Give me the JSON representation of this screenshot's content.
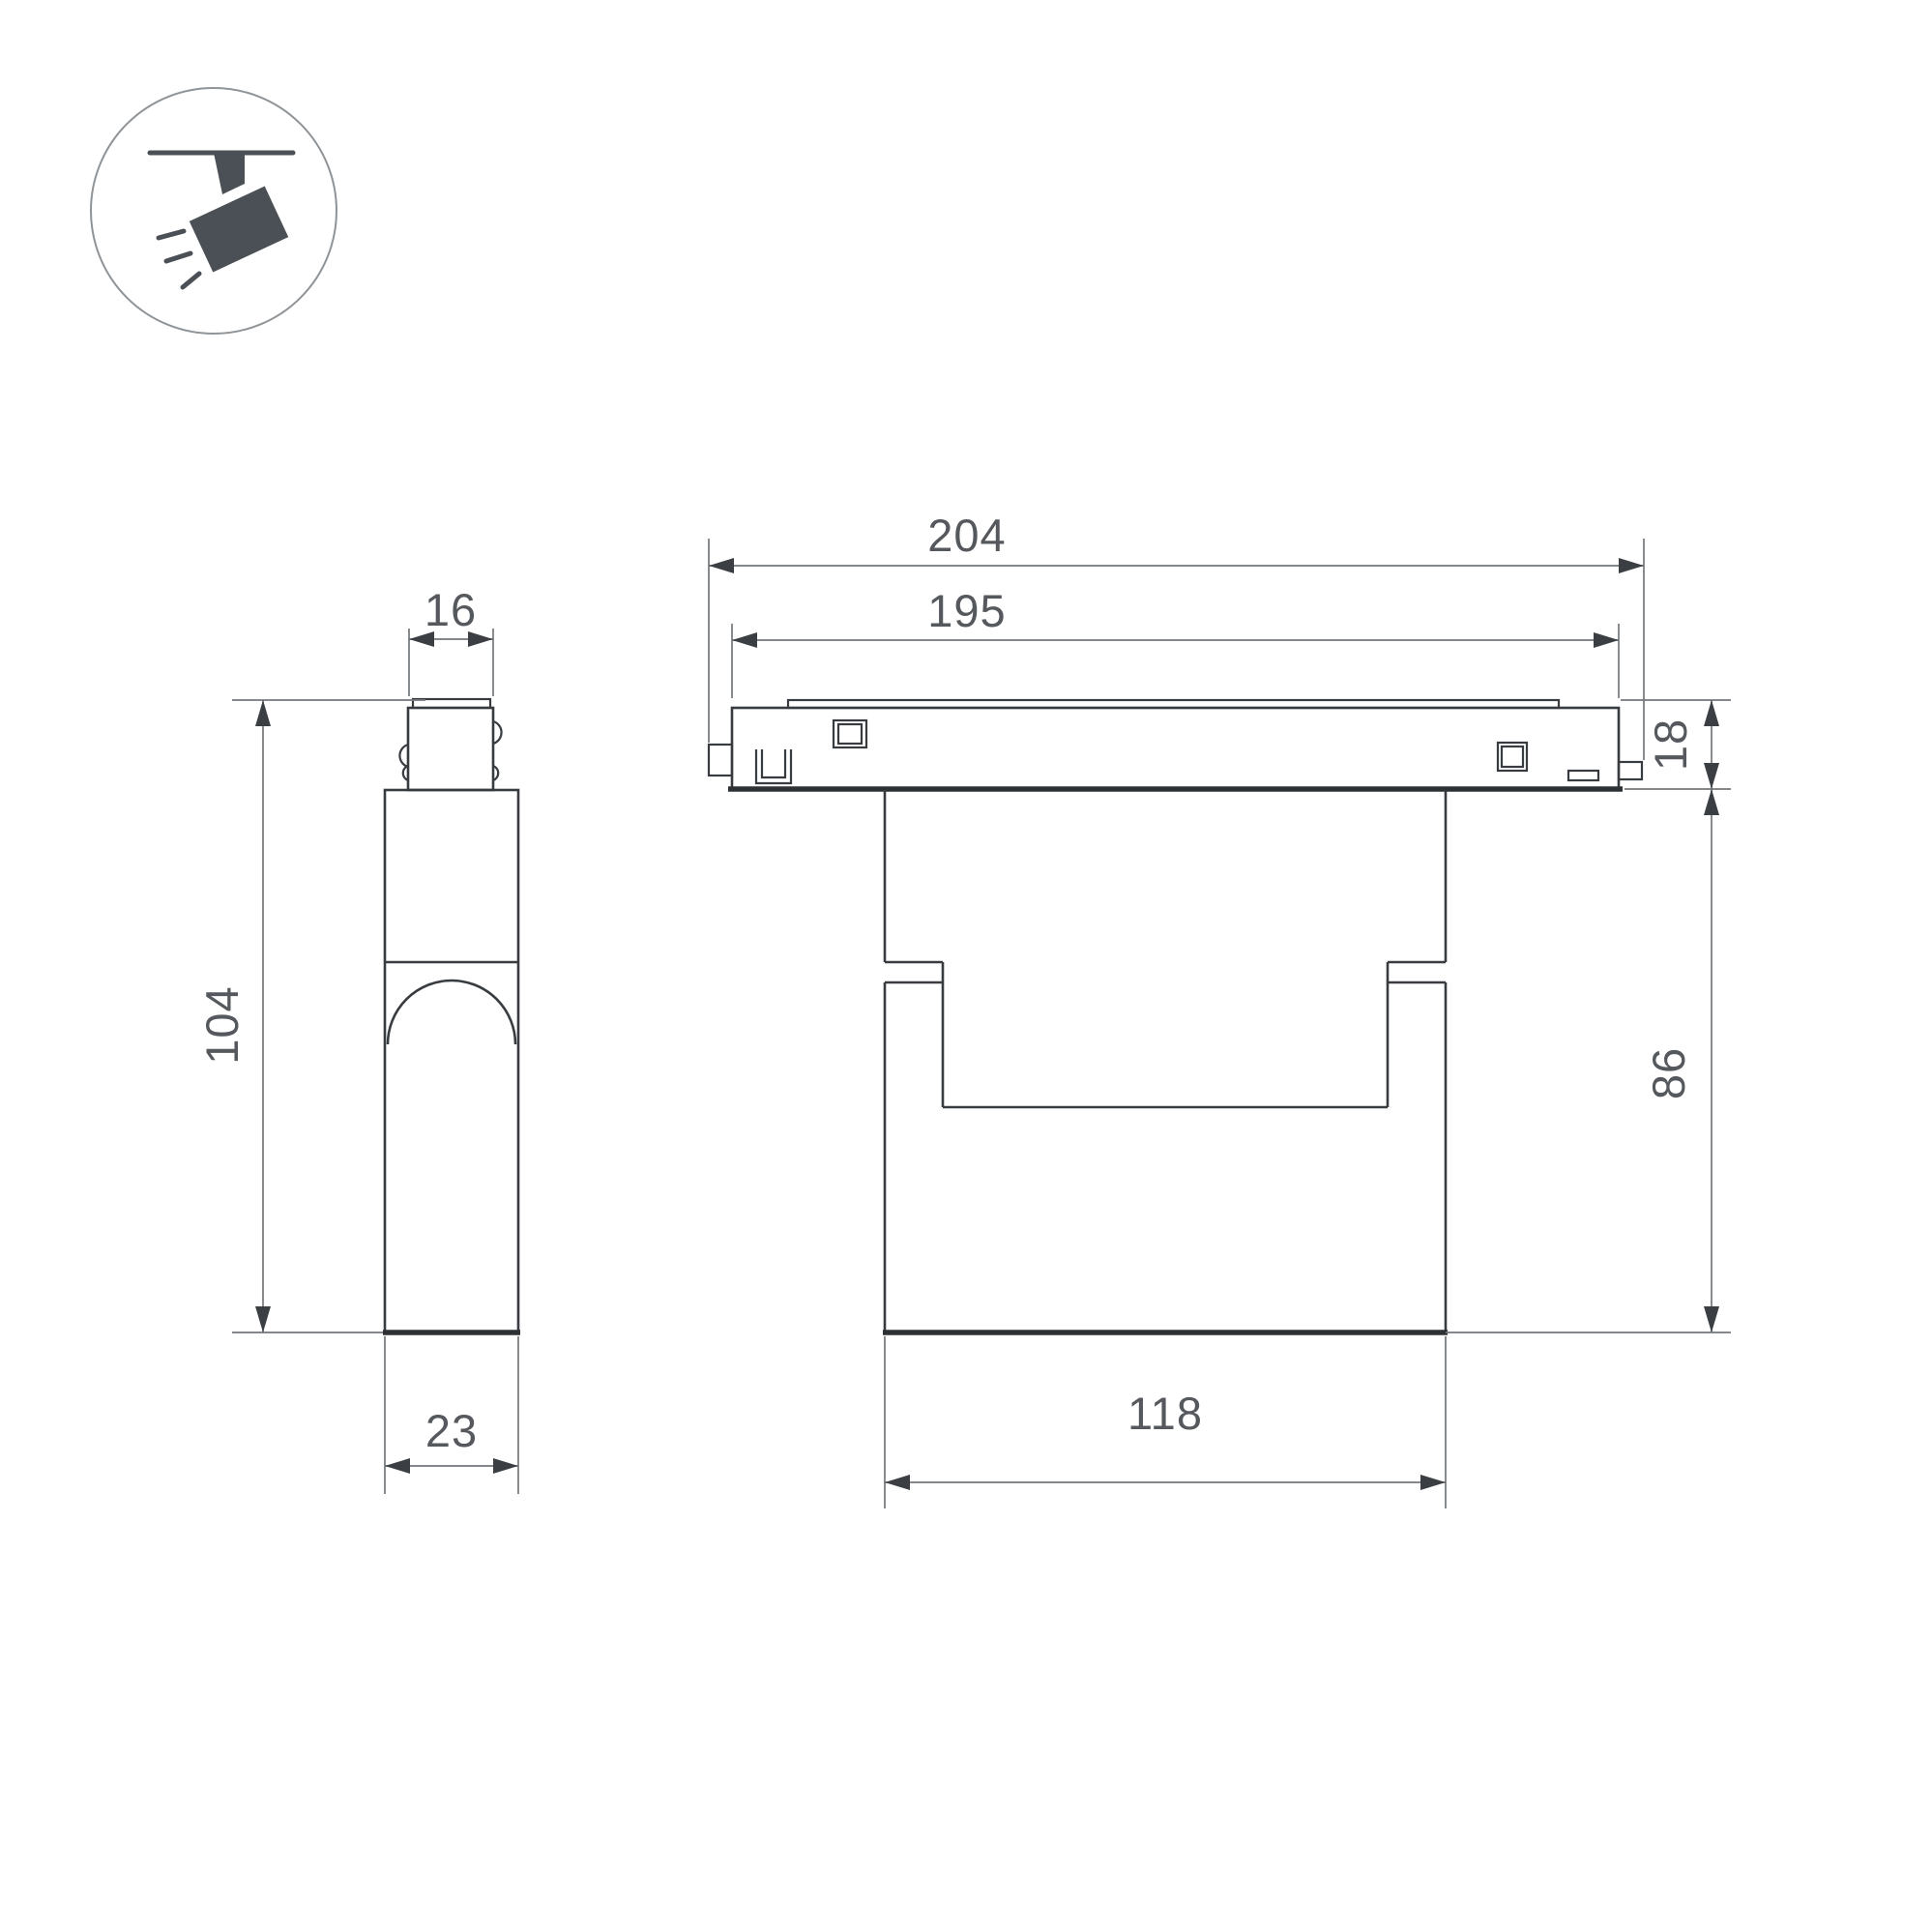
{
  "drawing": {
    "kind": "technical-dimension-drawing",
    "icon": {
      "name": "track-spotlight-icon"
    },
    "colors": {
      "outline": "#383c40",
      "dimension_lines": "#73777b",
      "text": "#55595d",
      "icon": "#4a5055",
      "background": "#ffffff"
    },
    "dims": {
      "overall_length": "204",
      "track_length": "195",
      "track_height": "18",
      "body_height": "86",
      "body_width": "118",
      "fixture_height": "104",
      "adapter_width": "16",
      "fixture_depth": "23"
    }
  }
}
